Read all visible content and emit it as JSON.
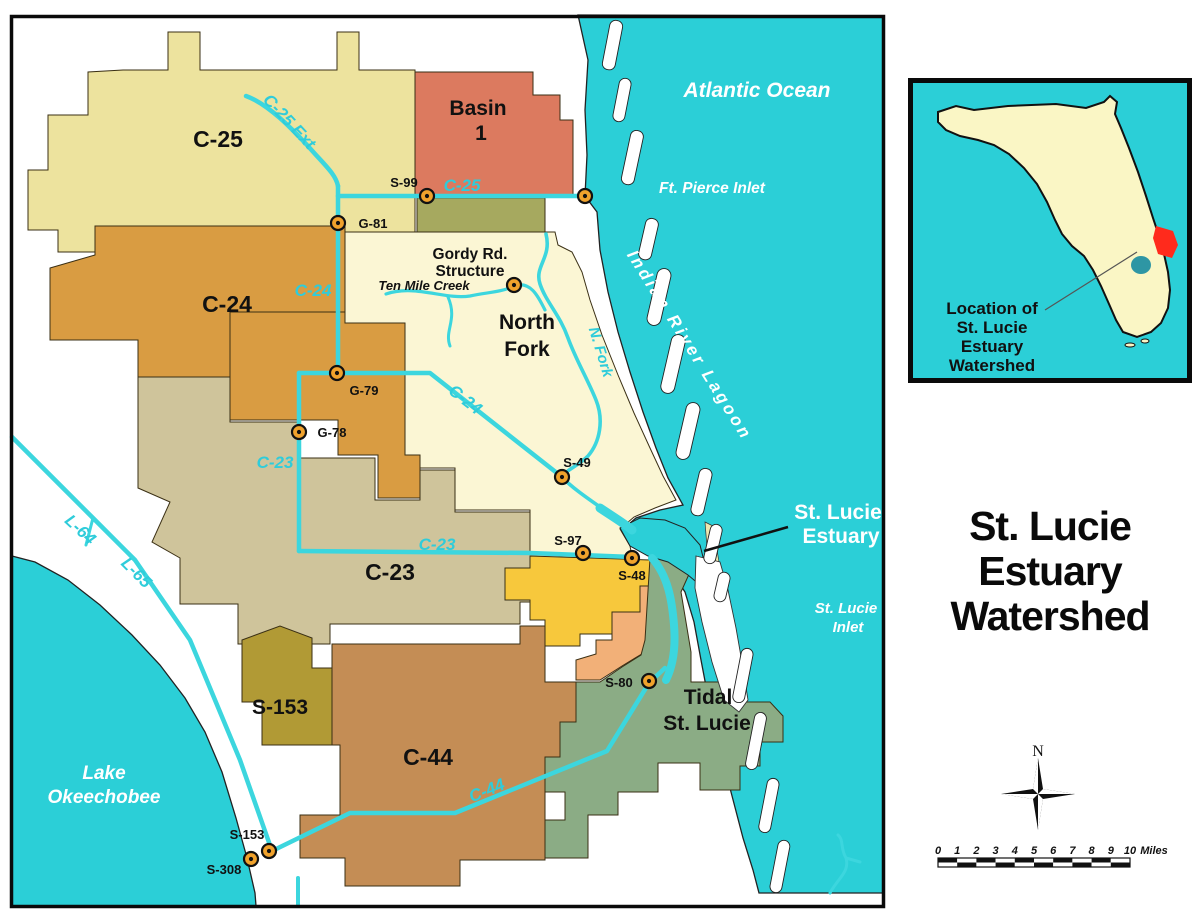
{
  "map": {
    "basin_labels": {
      "c25": "C-25",
      "basin1_l1": "Basin",
      "basin1_l2": "1",
      "c24": "C-24",
      "north_fork_l1": "North",
      "north_fork_l2": "Fork",
      "c23": "C-23",
      "s153": "S-153",
      "c44": "C-44",
      "tidal_l1": "Tidal",
      "tidal_l2": "St. Lucie"
    },
    "canal_labels": {
      "c25_ext": "C-25 Ext",
      "c25": "C-25",
      "c24_upper": "C-24",
      "c24_lower": "C-24",
      "c23_upper": "C-23",
      "c23_lower": "C-23",
      "c44": "C-44",
      "l64": "L-64",
      "l65": "L-65",
      "n_fork": "N. Fork"
    },
    "structure_labels": {
      "s99": "S-99",
      "g81": "G-81",
      "g79": "G-79",
      "g78": "G-78",
      "s49": "S-49",
      "s97": "S-97",
      "s48": "S-48",
      "s80": "S-80",
      "s153": "S-153",
      "s308": "S-308",
      "gordy_l1": "Gordy Rd.",
      "gordy_l2": "Structure",
      "ten_mile_creek": "Ten Mile Creek"
    },
    "water_labels": {
      "atlantic": "Atlantic Ocean",
      "ft_pierce": "Ft. Pierce Inlet",
      "indian_river": "Indian River Lagoon",
      "estuary_l1": "St. Lucie",
      "estuary_l2": "Estuary",
      "st_lucie_inlet_l1": "St. Lucie",
      "st_lucie_inlet_l2": "Inlet",
      "lake_l1": "Lake",
      "lake_l2": "Okeechobee"
    }
  },
  "inset": {
    "caption_l1": "Location of",
    "caption_l2": "St. Lucie",
    "caption_l3": "Estuary",
    "caption_l4": "Watershed"
  },
  "title": {
    "lines": [
      "St. Lucie",
      "Estuary",
      "Watershed"
    ]
  },
  "compass": {
    "north": "N"
  },
  "scalebar": {
    "ticks": [
      "0",
      "1",
      "2",
      "3",
      "4",
      "5",
      "6",
      "7",
      "8",
      "9",
      "10"
    ],
    "unit": "Miles"
  },
  "colors": {
    "water": "#2BCFD7",
    "canal": "#3CD6DE",
    "basin_c25": "#EDE39E",
    "basin_1": "#DC7A5F",
    "basin_olive": "#A6A95F",
    "basin_north_fork": "#FBF6D4",
    "basin_c24": "#D99C42",
    "basin_c23": "#CFC49B",
    "basin_yellow": "#F7C83C",
    "basin_peach": "#F2B078",
    "basin_tidal": "#8BAC85",
    "basin_s153": "#B19A35",
    "basin_c44": "#C48D55",
    "structure_fill": "#F0A22C",
    "inset_land": "#FAF6C5",
    "inset_red": "#FF2A1C",
    "inset_lake": "#2E96A4"
  }
}
